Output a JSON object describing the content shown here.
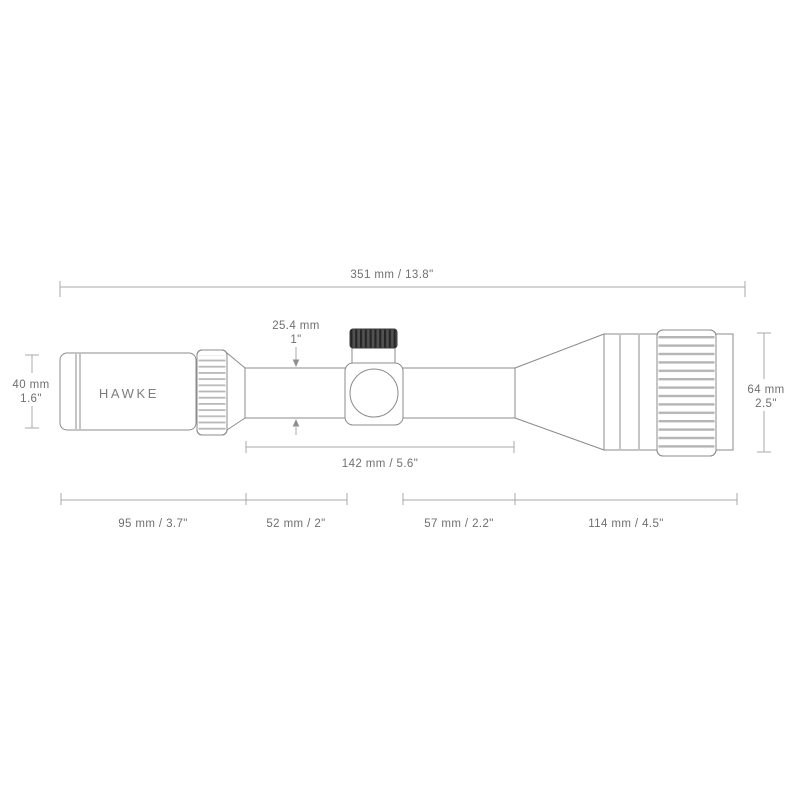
{
  "brand": "HAWKE",
  "dimensions": {
    "total_length": "351 mm / 13.8\"",
    "tube_mm": "25.4 mm",
    "tube_in": "1\"",
    "ocular": {
      "mm": "40 mm",
      "in": "1.6\""
    },
    "objective": {
      "mm": "64 mm",
      "in": "2.5\""
    },
    "tube_span": "142 mm / 5.6\"",
    "segments": {
      "eyepiece": "95 mm / 3.7\"",
      "rear_tube": "52 mm / 2\"",
      "front_tube": "57 mm / 2.2\"",
      "objective": "114 mm / 4.5\""
    }
  },
  "colors": {
    "line": "#8b8b8b",
    "dimension_line": "#a9a9a9",
    "text": "#6f6f6f",
    "turret_cap_dark": "#4e4e4e"
  }
}
